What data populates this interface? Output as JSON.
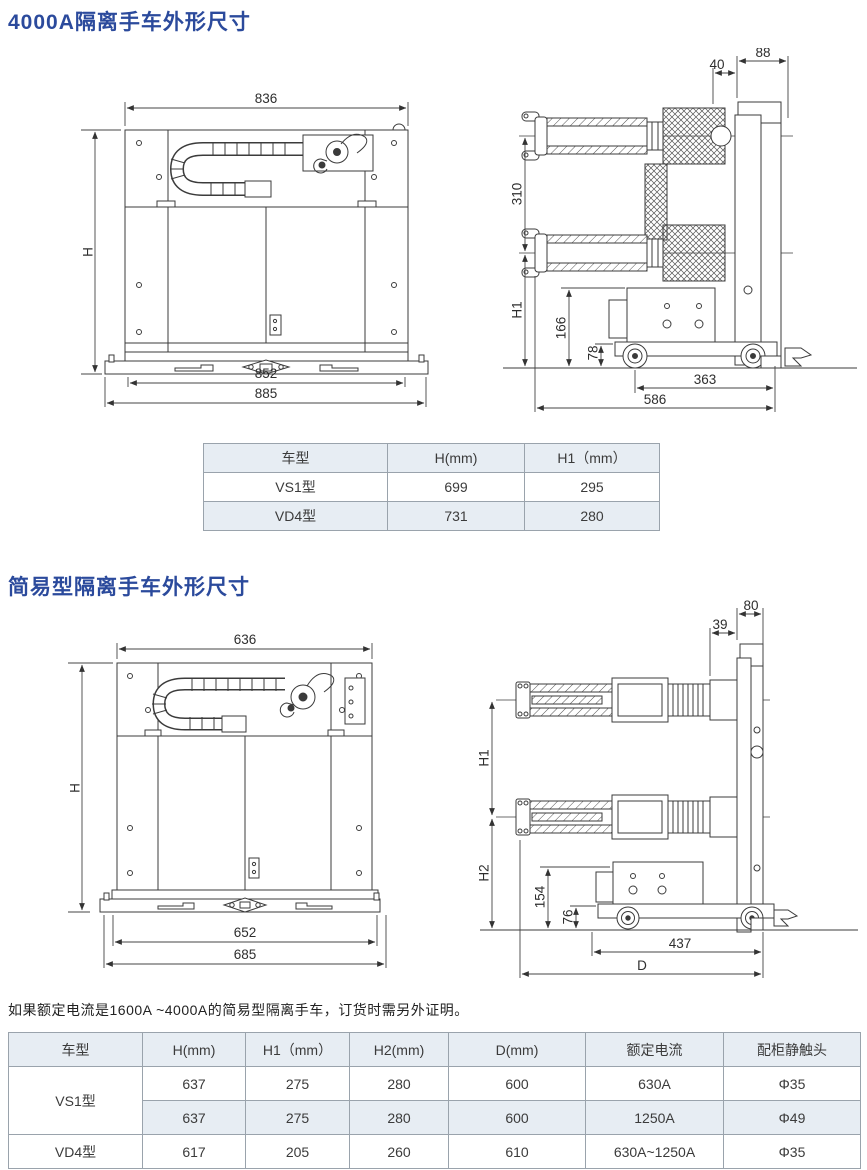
{
  "s1": {
    "title": "4000A隔离手车外形尺寸",
    "front": {
      "w_top": "836",
      "h": "H",
      "w_mid": "852",
      "w_bot": "885"
    },
    "side": {
      "d40": "40",
      "d88": "88",
      "d310": "310",
      "h1": "H1",
      "d166": "166",
      "d78": "78",
      "d363": "363",
      "d586": "586"
    },
    "table": {
      "headers": [
        "车型",
        "H(mm)",
        "H1（mm）"
      ],
      "rows": [
        [
          "VS1型",
          "699",
          "295"
        ],
        [
          "VD4型",
          "731",
          "280"
        ]
      ]
    }
  },
  "s2": {
    "title": "简易型隔离手车外形尺寸",
    "front": {
      "w_top": "636",
      "h": "H",
      "w_mid": "652",
      "w_bot": "685"
    },
    "side": {
      "d39": "39",
      "d80": "80",
      "h1": "H1",
      "h2": "H2",
      "d154": "154",
      "d76": "76",
      "d437": "437",
      "dD": "D"
    },
    "note": "如果额定电流是1600A ~4000A的简易型隔离手车，订货时需另外证明。",
    "table": {
      "headers": [
        "车型",
        "H(mm)",
        "H1（mm）",
        "H2(mm)",
        "D(mm)",
        "额定电流",
        "配柜静触头"
      ],
      "rows": [
        [
          "VS1型",
          "637",
          "275",
          "280",
          "600",
          "630A",
          "Φ35"
        ],
        [
          "637",
          "275",
          "280",
          "600",
          "1250A",
          "Φ49"
        ],
        [
          "VD4型",
          "617",
          "205",
          "260",
          "610",
          "630A~1250A",
          "Φ35"
        ]
      ]
    }
  },
  "colors": {
    "title_blue": "#2b4a9c",
    "table_shade": "#e7edf3",
    "line": "#3b3b3b"
  }
}
